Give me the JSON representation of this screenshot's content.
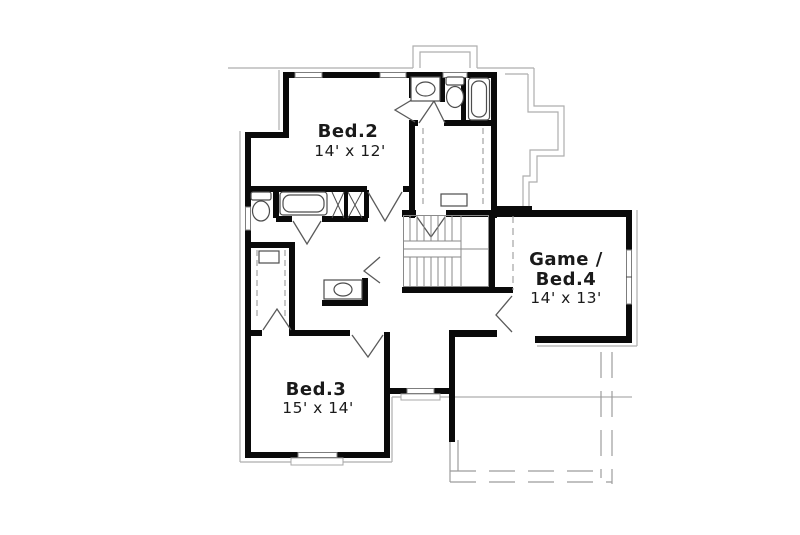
{
  "plan": {
    "rooms": {
      "bed2": {
        "name": "Bed.2",
        "dims": "14' x 12'"
      },
      "game_bed4": {
        "name_line1": "Game /",
        "name_line2": "Bed.4",
        "dims": "14' x 13'"
      },
      "bed3": {
        "name": "Bed.3",
        "dims": "15' x 14'"
      }
    },
    "fixtures": [
      "sink",
      "toilet",
      "bathtub",
      "vanity-sink",
      "staircase",
      "closet-rods",
      "linen-shelves",
      "bay-window"
    ],
    "colors": {
      "wall": "#0a0a0a",
      "fixture_line": "#4d4d4d",
      "stair_line": "#8a8a8a",
      "roof_line": "#aeaeae",
      "porch_dashed_line": "#9c9c9c",
      "label_text": "#1a1a1a",
      "background": "#ffffff"
    }
  }
}
